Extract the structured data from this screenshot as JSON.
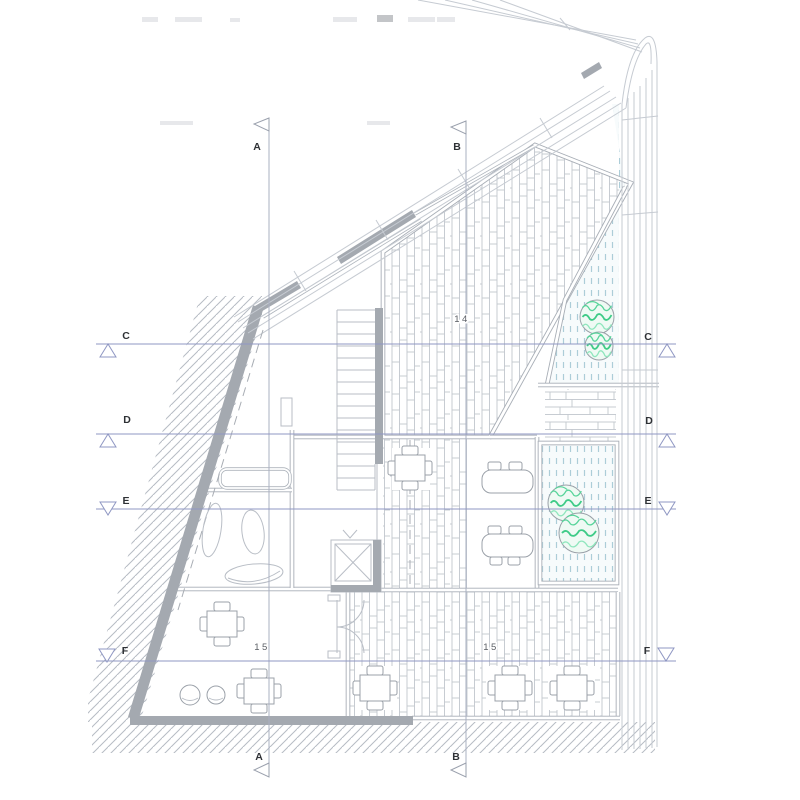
{
  "document": {
    "kind": "architectural floor plan",
    "view": "upper floor plan"
  },
  "rooms": {
    "room14": "14",
    "room15_left": "15",
    "room15_right": "15"
  },
  "sections": {
    "vertical": [
      {
        "id": "A"
      },
      {
        "id": "B"
      }
    ],
    "horizontal": [
      {
        "id": "C"
      },
      {
        "id": "D"
      },
      {
        "id": "E"
      },
      {
        "id": "F"
      }
    ]
  },
  "furniture": {
    "tables_4chair": [
      [
        410,
        468
      ],
      [
        222,
        624
      ],
      [
        259,
        691
      ],
      [
        375,
        688
      ],
      [
        510,
        688
      ],
      [
        572,
        688
      ]
    ],
    "desks": [
      {
        "x": 482,
        "y": 470,
        "tabs": "top"
      },
      {
        "x": 482,
        "y": 534,
        "tabs": "both"
      }
    ],
    "stools": [
      [
        190,
        695,
        10
      ],
      [
        216,
        695,
        9
      ]
    ],
    "trees": [
      [
        597,
        317,
        17
      ],
      [
        599,
        346,
        14
      ],
      [
        566,
        503,
        18
      ],
      [
        579,
        533,
        20
      ]
    ]
  },
  "colors": {
    "wall_gray": "#a4a9b0",
    "line": "#b9bec6",
    "double_wall": "#a8aeb6",
    "section_line": "#8f97c3",
    "marker_text": "#2e3135",
    "stipple": "#accdd8",
    "stipple_bg": "#f7fbfc",
    "tree_green": "#57d49a",
    "tree_green_dark": "#3ecb87",
    "plank_line": "#c1c6cd",
    "hatch_line": "#b6bcc4"
  }
}
